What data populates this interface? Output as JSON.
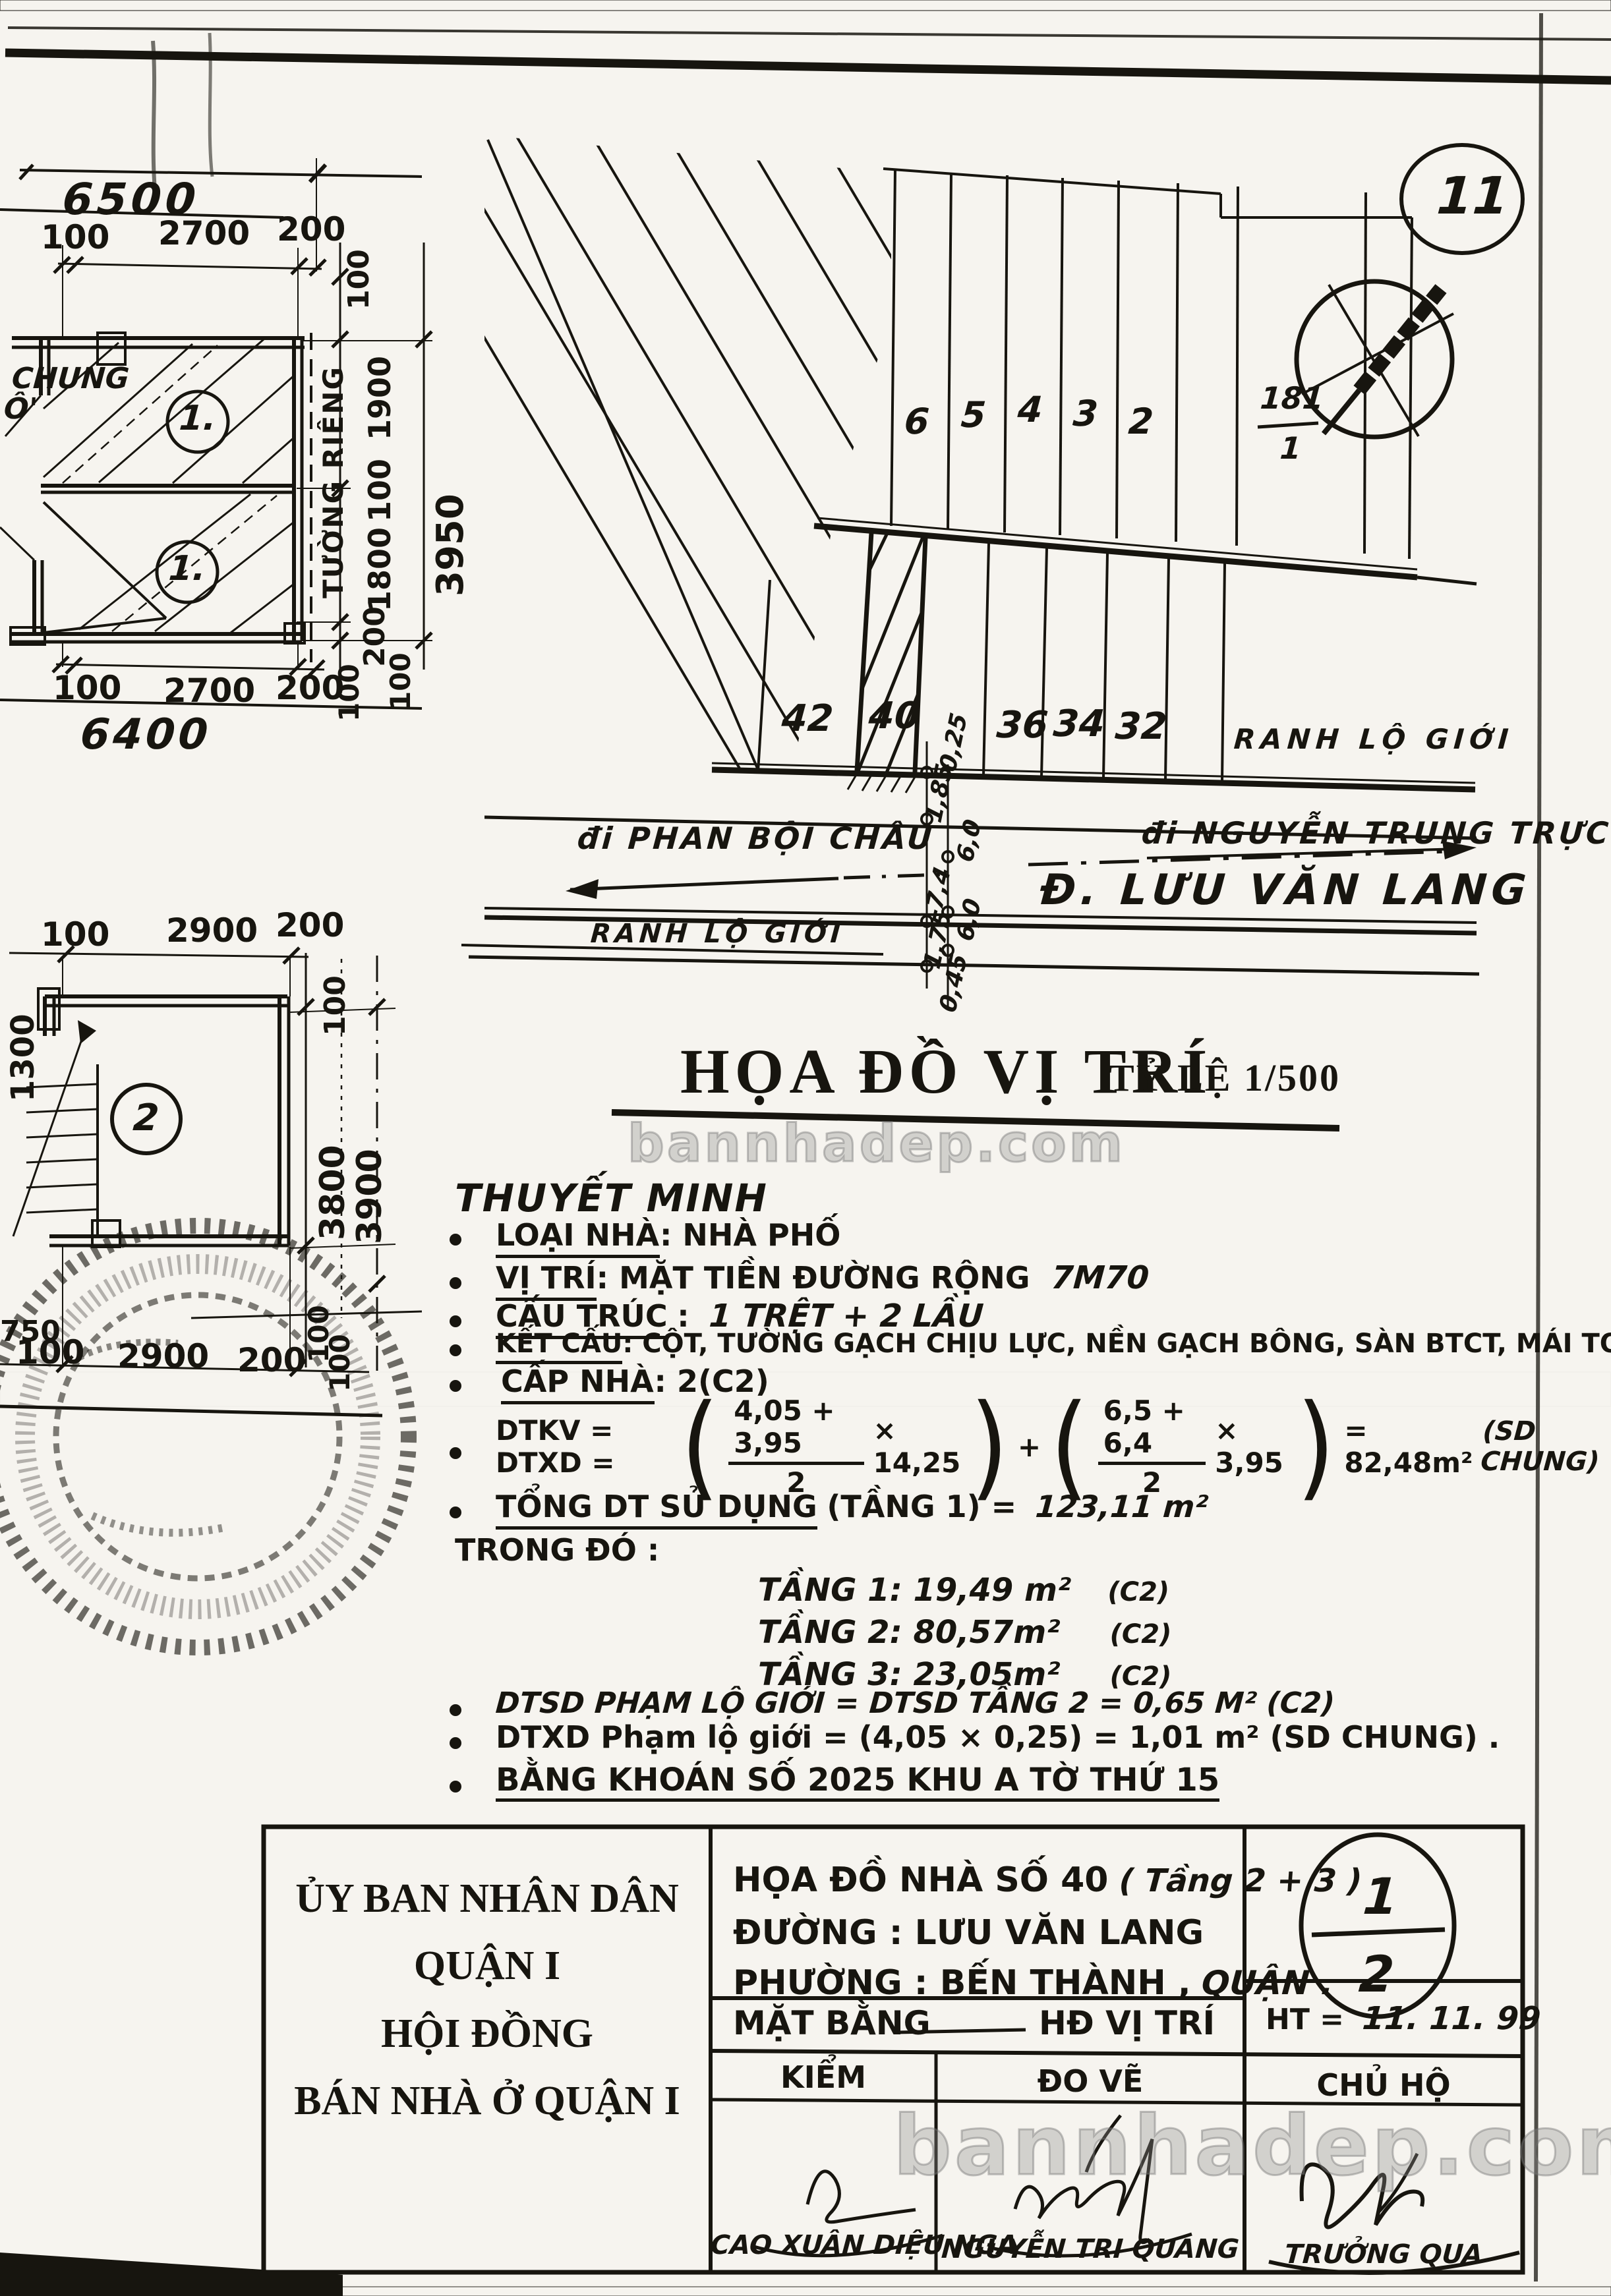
{
  "page": {
    "number": "11"
  },
  "watermark": {
    "text": "bannhadep.com"
  },
  "plan_a": {
    "total_top": "6500",
    "top_d1": "100",
    "top_d2": "2700",
    "top_d3": "200",
    "side_top": "100",
    "side_d1": "1900",
    "side_d2": "100",
    "side_d3": "1800",
    "side_d4": "200",
    "side_total": "3950",
    "side_b1": "100",
    "side_b2": "200",
    "side_b3": "100",
    "bot_d1": "100",
    "bot_d2": "2700",
    "bot_d3": "200",
    "total_bottom": "6400",
    "wall_label": "TƯỜNG RIÊNG",
    "frag1": "CHUNG",
    "frag2": "Ô'",
    "room1": "1.",
    "room2": "1."
  },
  "plan_b": {
    "top_d1": "100",
    "top_d2": "2900",
    "top_d3": "200",
    "bot_d1": "100",
    "bot_d2": "2900",
    "bot_d3": "200",
    "left_dim": "1300",
    "left_frag": "750",
    "side_top": "100",
    "side_d1": "3800",
    "side_d2": "3900",
    "side_b1": "100",
    "side_b2": "100",
    "room": "2"
  },
  "site": {
    "lot_u1": "6",
    "lot_u2": "5",
    "lot_u3": "4",
    "lot_u4": "3",
    "lot_u5": "2",
    "corner_num": "181",
    "corner_den": "1",
    "lot_l1": "42",
    "lot_l2": "40",
    "lot_l3": "36",
    "lot_l4": "34",
    "lot_l5": "32",
    "ranh_right": "RANH LỘ GIỚI",
    "ranh_left": "RANH LỘ GIỚI",
    "dir_left": "đi PHAN BỘI CHÂU",
    "dir_right": "đi NGUYỄN TRUNG TRỰC",
    "street": "Đ. LƯU VĂN LANG",
    "c1": "0,25",
    "c2": "1,85",
    "c3": "6,0",
    "c4": "7,4",
    "c5": "6,0",
    "c6": "1,75",
    "c7": "0,45"
  },
  "title": {
    "main": "HỌA ĐỒ VỊ TRÍ",
    "scale": "TỶ LỆ 1/500"
  },
  "notes": {
    "heading": "THUYẾT MINH",
    "loai_label": "LOẠI NHÀ",
    "loai_value": ":  NHÀ PHỐ",
    "vitri_label": "VỊ TRÍ",
    "vitri_value": ":  MẶT TIỀN ĐƯỜNG RỘNG",
    "vitri_hand": "7M70",
    "cautruc_label": "CẤU TRÚC",
    "cautruc_colon": ":",
    "cautruc_hand": "1 TRỆT + 2 LẦU",
    "ketcau_label": "KẾT CẤU",
    "ketcau_value": ":  CỘT, TƯỜNG GẠCH CHỊU LỰC, NỀN GẠCH BÔNG, SÀN BTCT, MÁI TOLE",
    "capnha_label": "CẤP NHÀ",
    "capnha_value": ":  2(C2)",
    "formula": {
      "lead": "DTKV = DTXD =",
      "open": "(",
      "close": ")",
      "f1_num": "4,05 + 3,95",
      "f1_den": "2",
      "f1_mult": "× 14,25",
      "plus": "+",
      "f2_num": "6,5 + 6,4",
      "f2_den": "2",
      "f2_mult": "× 3,95",
      "result": "= 82,48m²",
      "note": "(SD CHUNG)"
    },
    "tong_label": "TỔNG DT SỬ DỤNG",
    "tong_mid": "(TẦNG 1) =",
    "tong_value": "123,11 m²",
    "trong_do": "TRONG ĐÓ :",
    "tang1": "TẦNG 1: 19,49 m²",
    "tang1_note": "(C2)",
    "tang2": "TẦNG 2: 80,57m²",
    "tang2_note": "(C2)",
    "tang3": "TẦNG 3: 23,05m²",
    "tang3_note": "(C2)",
    "dtsd_line": "DTSD PHẠM LỘ GIỚI = DTSD TẦNG 2 = 0,65 M² (C2)",
    "dtxd_line": "DTXD Phạm lộ giới = (4,05 × 0,25) = 1,01 m²  (SD CHUNG) .",
    "bang_khoan": "BẰNG KHOÁN SỐ  2025 KHU A TỜ THỨ 15"
  },
  "block": {
    "org_lines": [
      "ỦY BAN NHÂN DÂN",
      "QUẬN I",
      "HỘI ĐỒNG",
      "BÁN NHÀ Ở QUẬN I"
    ],
    "doc_line1": "HỌA ĐỒ NHÀ SỐ 40",
    "doc_line1_hand": "( Tầng 2 + 3 )",
    "doc_line2": "ĐƯỜNG : LƯU VĂN LANG",
    "doc_line3": "PHƯỜNG : BẾN THÀNH ,",
    "doc_line3_hand": "QUẬN .",
    "sheet_top": "1",
    "sheet_bottom": "2",
    "row2_left": "MẶT BẰNG",
    "row2_right": "HĐ VỊ TRÍ",
    "date_label": "HT =",
    "date_value": "11. 11. 99",
    "sign_headers": [
      "KIỂM",
      "ĐO VẼ",
      "CHỦ HỘ"
    ],
    "sign_names": [
      "CAO XUÂN DIỆU NGA",
      "NGUYỄN TRI QUANG",
      "TRƯỞNG QUA"
    ]
  }
}
